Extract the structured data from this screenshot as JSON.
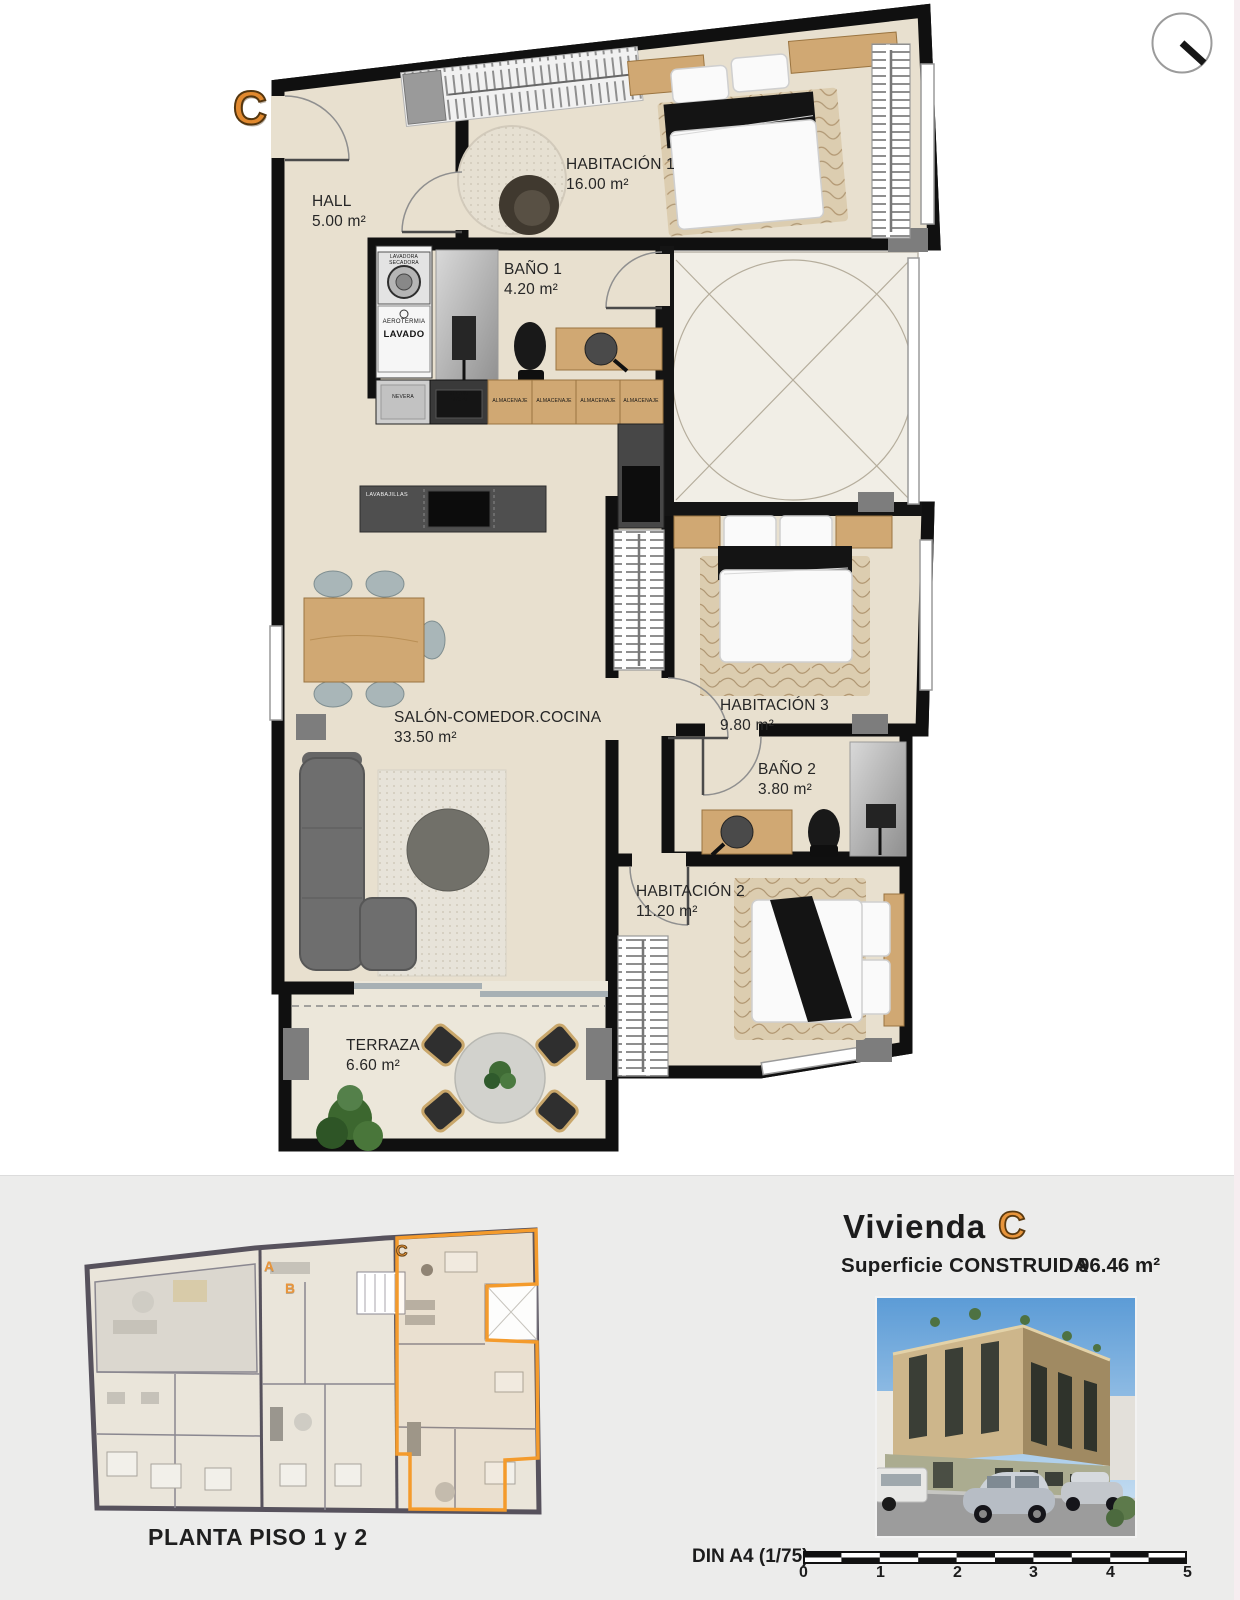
{
  "sheet": {
    "unit_marker": "C",
    "rooms": {
      "hall": {
        "name": "HALL",
        "area": "5.00 m²"
      },
      "habitacion1": {
        "name": "HABITACIÓN 1",
        "area": "16.00 m²"
      },
      "bano1": {
        "name": "BAÑO 1",
        "area": "4.20 m²"
      },
      "salon": {
        "name": "SALÓN-COMEDOR.COCINA",
        "area": "33.50 m²"
      },
      "habitacion3": {
        "name": "HABITACIÓN 3",
        "area": "9.80 m²"
      },
      "bano2": {
        "name": "BAÑO 2",
        "area": "3.80 m²"
      },
      "habitacion2": {
        "name": "HABITACIÓN 2",
        "area": "11.20 m²"
      },
      "terraza": {
        "name": "TERRAZA",
        "area": "6.60 m²"
      }
    },
    "appliances": {
      "lavadora_l1": "LAVADORA",
      "lavadora_l2": "SECADORA",
      "aerotermia": "AEROTERMIA",
      "lavado": "LAVADO",
      "nevera": "NEVERA",
      "horno_l1": "HORNO",
      "horno_l2": "MICRO",
      "almacenaje": "ALMACENAJE",
      "lavabajillas": "LAVABAJILLAS"
    }
  },
  "overview": {
    "unit_a": "A",
    "unit_b": "B",
    "unit_c": "C",
    "caption": "PLANTA PISO 1 y 2"
  },
  "info": {
    "title": "Vivienda",
    "unit": "C",
    "surface_label": "Superficie CONSTRUIDA",
    "surface_value": "96.46 m²"
  },
  "scalebar": {
    "label": "DIN A4 (1/75)",
    "ticks": [
      "0",
      "1",
      "2",
      "3",
      "4",
      "5"
    ]
  },
  "colors": {
    "accent": "#E8913A",
    "walls": "#111111",
    "floor": "#E8E0CF"
  }
}
